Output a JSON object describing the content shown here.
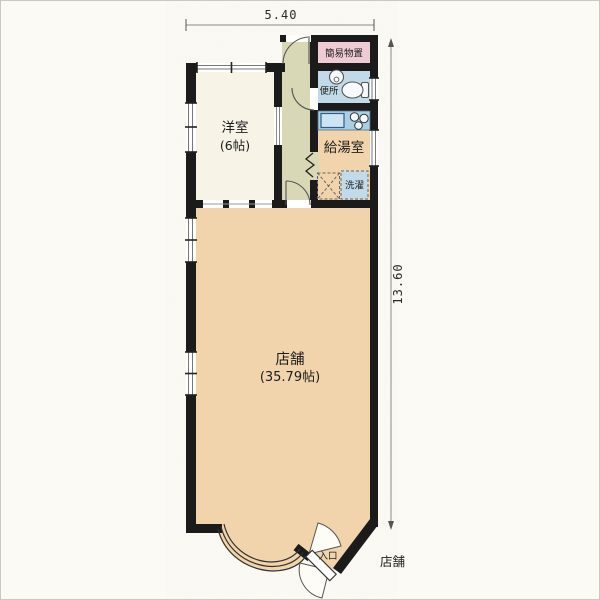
{
  "plan": {
    "dimensions": {
      "top": "5.40",
      "right": "13.60"
    },
    "rooms": {
      "storage": {
        "label": "簡易物置"
      },
      "toilet": {
        "label": "便所"
      },
      "kitchen": {
        "label": "給湯室"
      },
      "laundry": {
        "label": "洗濯"
      },
      "western": {
        "label": "洋室",
        "size": "(6帖)"
      },
      "shop": {
        "label": "店舗",
        "size": "(35.79帖)"
      }
    },
    "entrance_label": "入口",
    "exterior_shop_label": "店舗",
    "colors": {
      "paper": "#fbfaf4",
      "wall": "#1b1b1b",
      "shop": "#f2d5ad",
      "western": "#f8f5e8",
      "hallway": "#d9d9b8",
      "storage": "#efccd5",
      "wet": "#c2dbea",
      "counter": "#aacfe5",
      "sink": "#cfe4f2",
      "line": "#555555",
      "dimline": "#8a8a84"
    }
  }
}
